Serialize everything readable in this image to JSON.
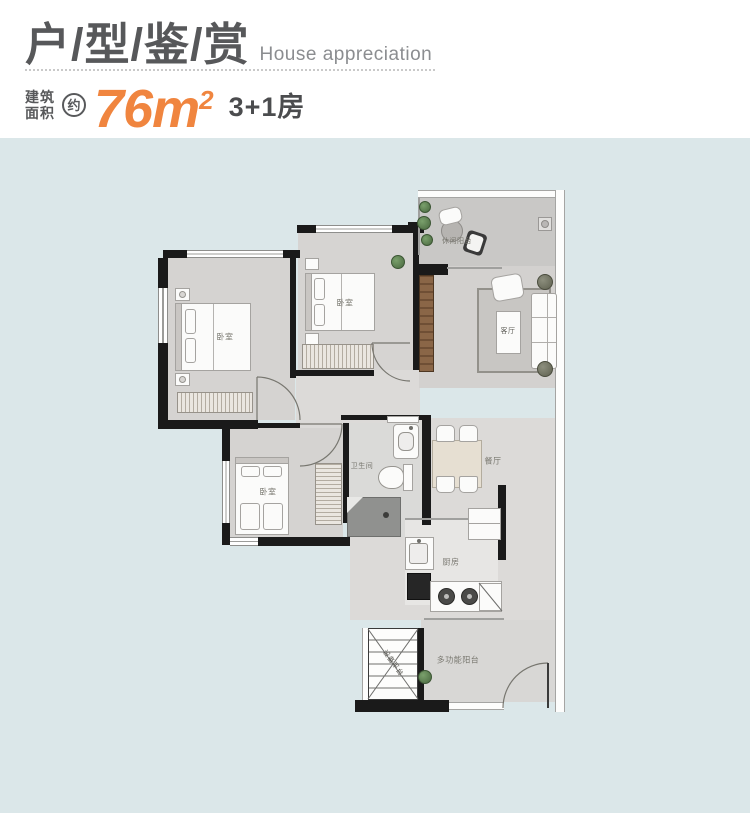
{
  "header": {
    "title_cn": "户/型/鉴/赏",
    "title_en": "House appreciation",
    "area_label_line1": "建筑",
    "area_label_line2": "面积",
    "approx": "约",
    "area_value": "76m",
    "area_sup": "2",
    "layout_text": "3+1房"
  },
  "colors": {
    "accent_orange": "#F0853F",
    "title_gray": "#57585A",
    "panel_blue": "#DBE7E9",
    "wall_black": "#1A1A1A"
  },
  "floorplan": {
    "rooms": [
      {
        "id": "bedroom-1",
        "label": "卧室"
      },
      {
        "id": "bedroom-2",
        "label": "卧室"
      },
      {
        "id": "bedroom-3",
        "label": "卧室"
      },
      {
        "id": "living-room",
        "label": "客厅"
      },
      {
        "id": "dining-room",
        "label": "餐厅"
      },
      {
        "id": "kitchen",
        "label": "厨房"
      },
      {
        "id": "bathroom",
        "label": "卫生间"
      },
      {
        "id": "leisure-balcony",
        "label": "休闲阳台"
      },
      {
        "id": "multi-balcony",
        "label": "多功能阳台"
      },
      {
        "id": "equipment-platform",
        "label": "设备平台"
      }
    ]
  }
}
